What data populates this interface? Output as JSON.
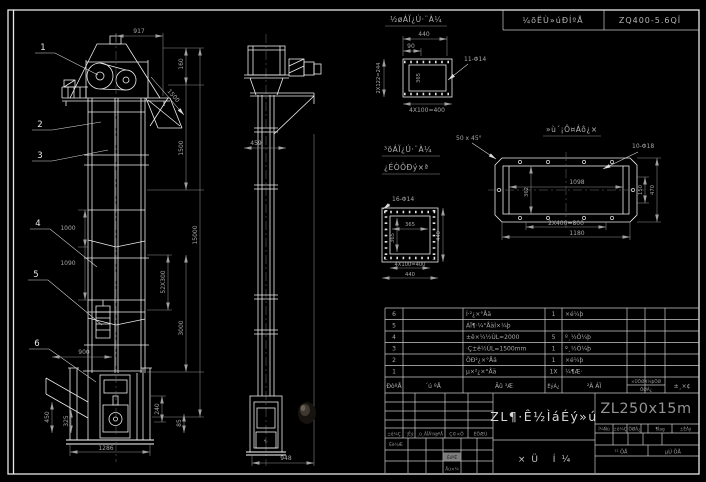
{
  "top_strip": {
    "left": "¼õËÙ»úÐÍºÅ",
    "right": "ZQ400-5.6QÎ"
  },
  "balloons": [
    "1",
    "2",
    "3",
    "4",
    "5",
    "6"
  ],
  "front_view": {
    "dims": {
      "head_width": "917",
      "d160": "160",
      "d1500_diag": "1500",
      "d1500": "1500",
      "total_height": "15000",
      "bucket_pitch": "52X300",
      "d3000": "3000",
      "d1000": "1000",
      "d1090": "1090",
      "hopper_width": "900",
      "d450": "450",
      "d325": "325",
      "d240": "240",
      "d85": "85",
      "base_width": "1286"
    }
  },
  "side_view": {
    "dims": {
      "flange": "459",
      "base": "948"
    },
    "boot_mark": "¶·"
  },
  "detail_inlet": {
    "title": "½øÁÏ¿Ú·¨À¼",
    "dims": {
      "width": "440",
      "offset": "90",
      "side": "2X122=244",
      "inner": "365",
      "pitch": "4X100=400",
      "holes": "11-Φ14"
    }
  },
  "detail_outlet": {
    "title_line1": "³öÁÏ¿Ú·¨À¼",
    "title_line2": "¿ÉÒÔÐý×ª",
    "dims": {
      "holes": "16-Φ14",
      "inner_w": "365",
      "inner_h": "365",
      "side": "440",
      "pitch": "4X100=400",
      "width": "440"
    }
  },
  "detail_base": {
    "title": "»ù´¡Ô¤Áô¿×",
    "dims": {
      "chamfer": "50 x 45°",
      "holes": "10-Φ18",
      "inner": "1098",
      "inner_h": "362",
      "right_inner": "150",
      "right_outer": "470",
      "pitch": "2X400=800",
      "width": "1180"
    }
  },
  "bom": {
    "headers": {
      "no": "ÐòºÅ",
      "code": "´ú ºÅ",
      "name": "Ãû ³Æ",
      "qty": "ÊýÁ¿",
      "material": "²Ä ÁÏ",
      "weight_top": "×ÜÖØX¼þÖØ",
      "weight_bottom": "ÖØÁ¿",
      "remarks": "±¸×¢"
    },
    "rows": [
      {
        "no": "6",
        "code": "",
        "name": "Í·²¿×°Åä",
        "qty": "1",
        "material": "×é¼þ"
      },
      {
        "no": "5",
        "code": "",
        "name": "ÁÏ¶·¼°ÅäÌ×¼þ",
        "qty": "",
        "material": ""
      },
      {
        "no": "4",
        "code": "",
        "name": "±ê×¼½ÚL=2000",
        "qty": "5",
        "material": "º¸½Ó¼þ"
      },
      {
        "no": "3",
        "code": "",
        "name": "·Ç±ê½ÚL=1500mm",
        "qty": "1",
        "material": "º¸½Ó¼þ"
      },
      {
        "no": "2",
        "code": "",
        "name": "ÖÐ²¿×°Åä",
        "qty": "1",
        "material": "×é¼þ"
      },
      {
        "no": "1",
        "code": "",
        "name": "µ×²¿×°Åä",
        "qty": "1X",
        "material": "¼¶Æ·"
      }
    ]
  },
  "title_block": {
    "drawing_name": "ZL¶·Ê½ÌáÉý»ú",
    "drawing_type": "×Ü Í¼",
    "model": "ZL250x15m",
    "rev_headers": [
      "±ê¼Ç",
      "´¦Êý",
      "¸ü¸ÄÎÄ¼þºÅ",
      "Ç©×Ö",
      "ÈÕÆÚ"
    ],
    "sig_design": "Éè¼Æ",
    "sig_check": "ÉóºË",
    "sig_approve": "Åú×¼",
    "right_headers": [
      "Í¼Ñù",
      "±ê¼Ç",
      "ÖØÁ¿",
      "¶Ìag",
      "±ÈÀý"
    ],
    "sheets_total": "¹² ÕÅ",
    "sheet_no": "µÚ ÕÅ"
  },
  "colors": {
    "background": "#000000",
    "line": "#ededed",
    "dim": "#8f8f8f",
    "model_text": "#939393"
  }
}
